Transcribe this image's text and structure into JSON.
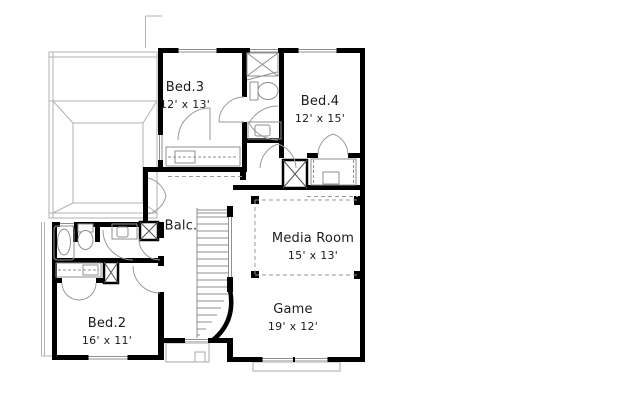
{
  "plan": {
    "type": "floor-plan",
    "floor": "second-floor",
    "background": "#ffffff",
    "wall_color": "#000000",
    "fixture_line_color": "#8f8f8f",
    "roof_line_color": "#b0b0b0",
    "dash_color": "#9a9a9a",
    "text_color": "#1c1c1c"
  },
  "rooms": [
    {
      "id": "bed3",
      "label": "Bed.3",
      "dimensions": "12' x 13'"
    },
    {
      "id": "bed4",
      "label": "Bed.4",
      "dimensions": "12' x 15'"
    },
    {
      "id": "balcony",
      "label": "Balc.",
      "dimensions": ""
    },
    {
      "id": "media",
      "label": "Media Room",
      "dimensions": "15' x 13'"
    },
    {
      "id": "game",
      "label": "Game",
      "dimensions": "19' x 12'"
    },
    {
      "id": "bed2",
      "label": "Bed.2",
      "dimensions": "16' x 11'"
    }
  ]
}
